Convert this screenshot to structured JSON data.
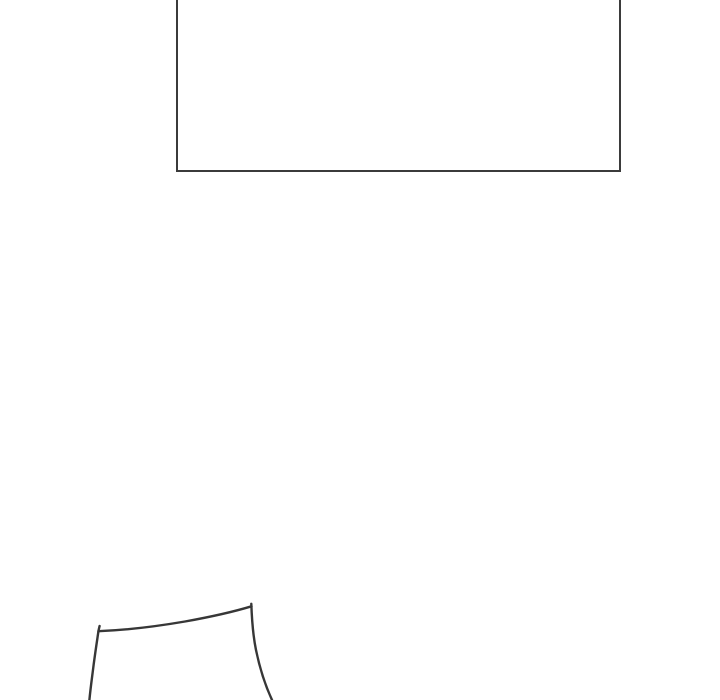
{
  "canvas": {
    "width": "720",
    "height": "700",
    "background_color": "#ffffff"
  },
  "panel": {
    "stroke_color": "#3b3b3b",
    "stroke_width": "2"
  },
  "sketch": {
    "stroke_color": "#373737",
    "stroke_width": "2.4"
  }
}
